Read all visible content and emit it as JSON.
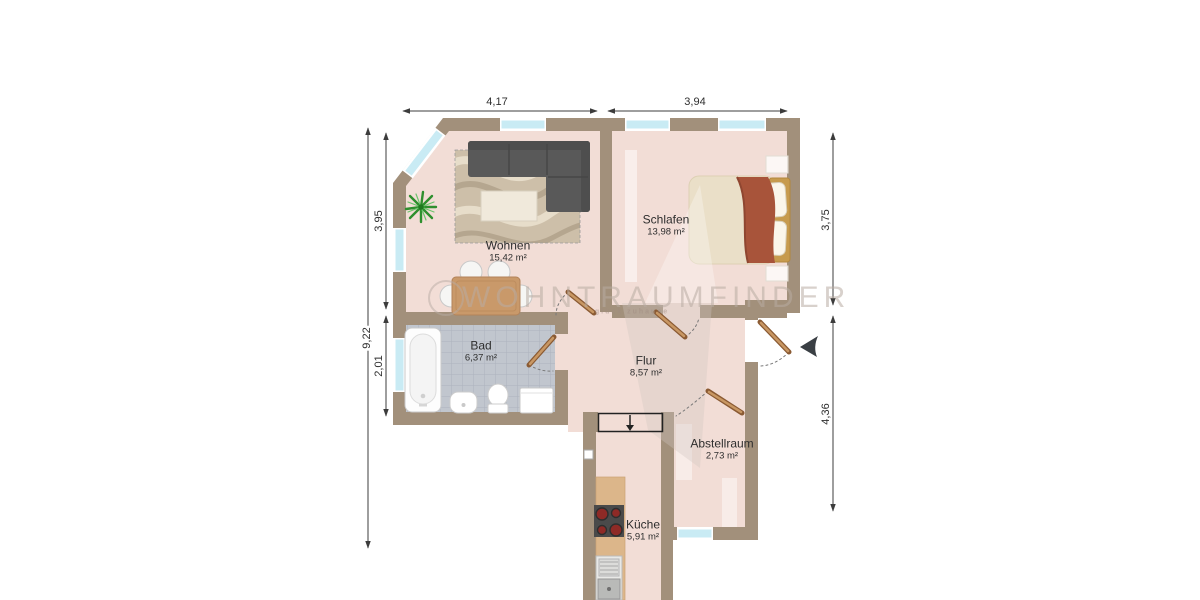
{
  "plan": {
    "watermark": {
      "brand": "WOHNTRAUMFINDER",
      "tagline": "glück zuhause"
    },
    "rooms": [
      {
        "id": "wohnen",
        "name": "Wohnen",
        "area": "15,42 m²"
      },
      {
        "id": "schlafen",
        "name": "Schlafen",
        "area": "13,98 m²"
      },
      {
        "id": "bad",
        "name": "Bad",
        "area": "6,37 m²"
      },
      {
        "id": "flur",
        "name": "Flur",
        "area": "8,57 m²"
      },
      {
        "id": "abstellraum",
        "name": "Abstellraum",
        "area": "2,73 m²"
      },
      {
        "id": "kueche",
        "name": "Küche",
        "area": "5,91 m²"
      }
    ],
    "dimensions": {
      "top_left": "4,17",
      "top_right": "3,94",
      "left_outer": "9,22",
      "left_upper": "3,95",
      "left_lower": "2,01",
      "right_upper": "3,75",
      "right_lower": "4,36"
    },
    "colors": {
      "wall": "#a2907b",
      "floor": "#f2ddd6",
      "window_glass": "#c9ebf4",
      "bath_tile": "#c1c6ce",
      "door": "#8a5a33",
      "sofa": "#595959",
      "bed_blanket": "#a8543a",
      "dimension_line": "#3c3c3c"
    }
  }
}
